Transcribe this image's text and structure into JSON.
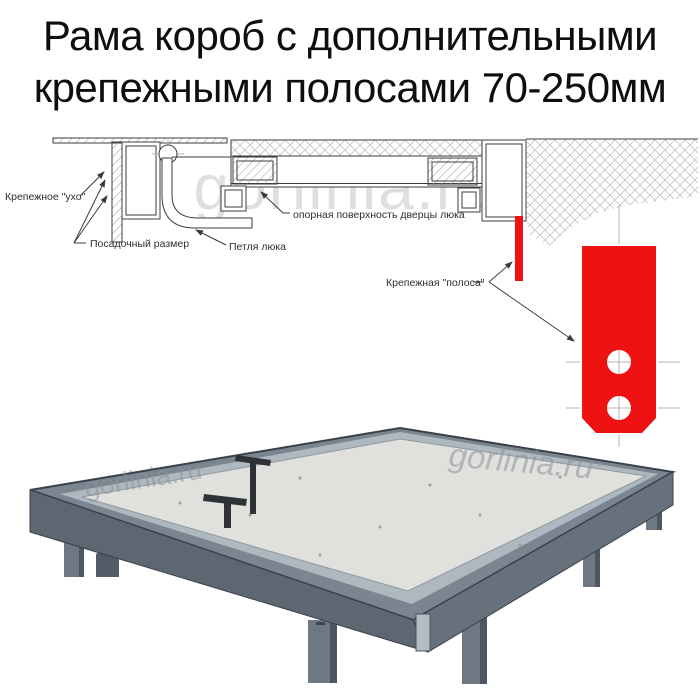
{
  "title": {
    "line1": "Рама короб с дополнительными",
    "line2": "крепежными полосами 70-250мм"
  },
  "watermark": "gorlinia.ru",
  "diagram": {
    "labels": {
      "ear": "Крепежное \"ухо\"",
      "seat_size": "Посадочный размер",
      "hinge": "Петля люка",
      "door_support": "опорная поверхность дверцы люка",
      "strip": "Крепежная \"полоса\""
    },
    "colors": {
      "red": "#ee1212",
      "line": "#3c3c3c",
      "hatch": "#9c9c9c",
      "centerline": "#b5b5b5",
      "watermark": "#dfdfdf"
    }
  },
  "photo": {
    "colors": {
      "frame_top": "#7b8590",
      "frame_side_left": "#5d6772",
      "frame_side_right": "#67717c",
      "panel": "#e0e1dc",
      "lip": "#aeb8c0",
      "leg": "#6e7883",
      "leg_dark": "#525c66",
      "handle": "#2e3237",
      "channel": "#b2bcc2"
    }
  }
}
